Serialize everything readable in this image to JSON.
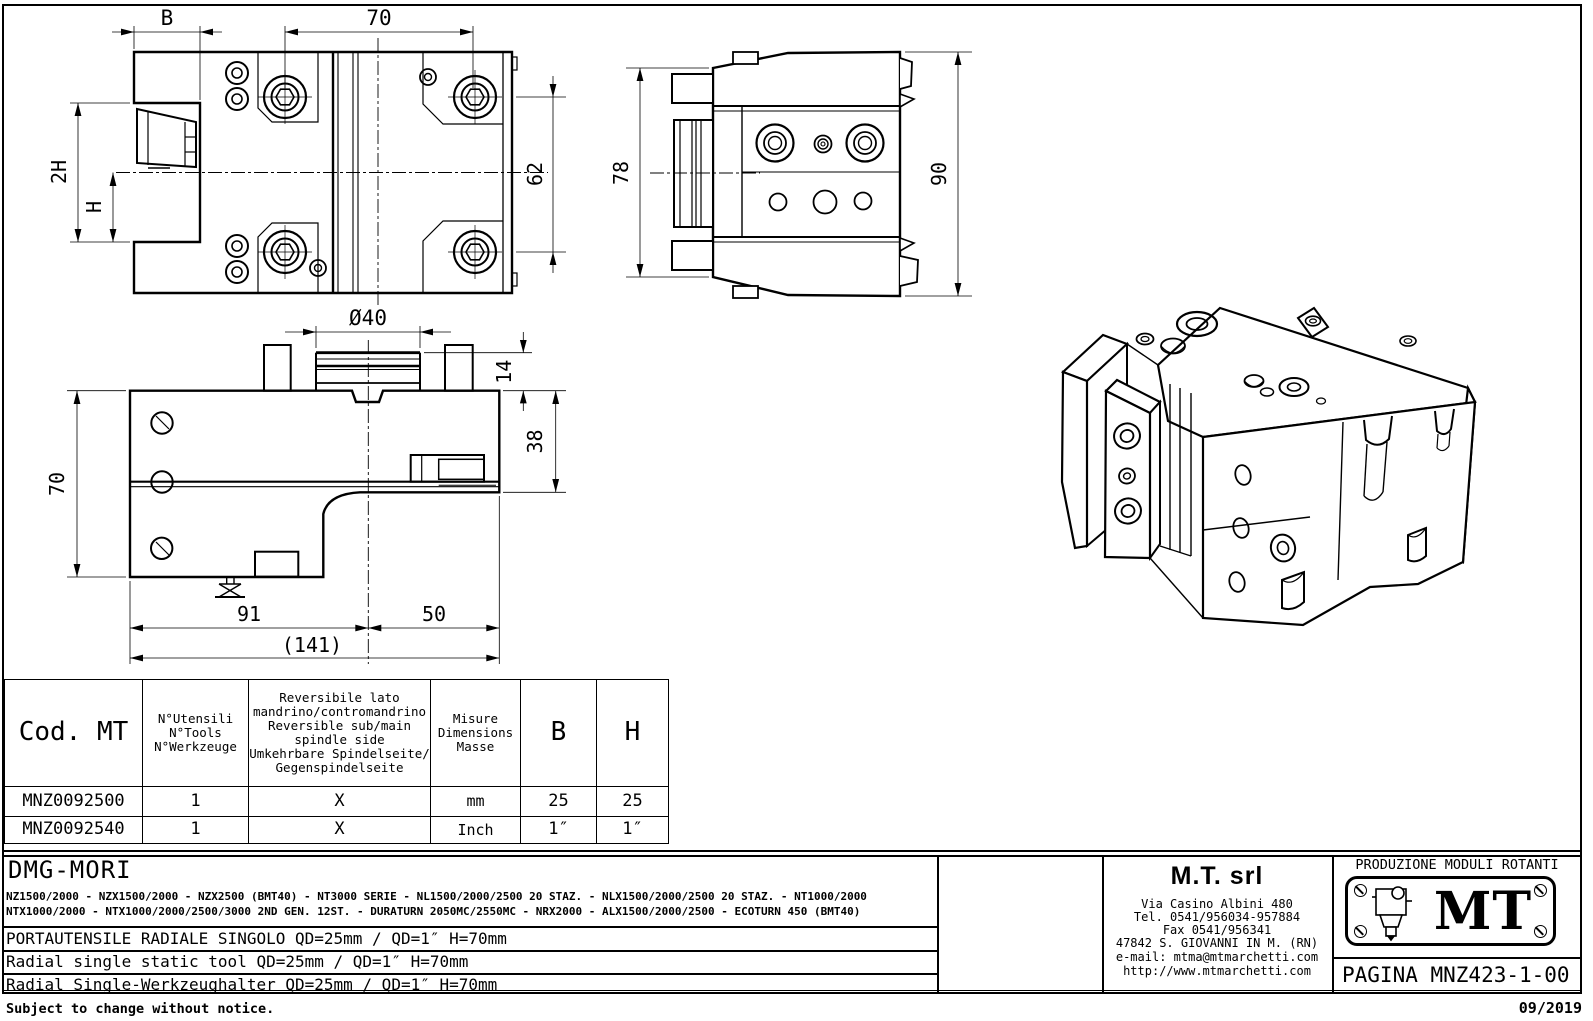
{
  "drawing": {
    "top_view": {
      "dim_b": "B",
      "dim_width": "70",
      "dim_2h": "2H",
      "dim_h": "H",
      "dim_62": "62"
    },
    "side_view": {
      "dim_78": "78",
      "dim_90": "90"
    },
    "front_view": {
      "dim_dia": "Ø40",
      "dim_14": "14",
      "dim_38": "38",
      "dim_70": "70",
      "dim_91": "91",
      "dim_50": "50",
      "dim_total": "(141)"
    }
  },
  "table": {
    "header": {
      "cod": "Cod. MT",
      "tools": [
        "N°Utensili",
        "N°Tools",
        "N°Werkzeuge"
      ],
      "reversible": [
        "Reversibile lato",
        "mandrino/contromandrino",
        "Reversible sub/main",
        "spindle side",
        "Umkehrbare Spindelseite/",
        "Gegenspindelseite"
      ],
      "measure": [
        "Misure",
        "Dimensions",
        "Masse"
      ],
      "b": "B",
      "h": "H"
    },
    "rows": [
      {
        "cod": "MNZ0092500",
        "tools": "1",
        "rev": "X",
        "unit": "mm",
        "b": "25",
        "h": "25"
      },
      {
        "cod": "MNZ0092540",
        "tools": "1",
        "rev": "X",
        "unit": "Inch",
        "b": "1″",
        "h": "1″"
      }
    ]
  },
  "title_block": {
    "brand": "DMG-MORI",
    "machines_line1": "NZ1500/2000 - NZX1500/2000 - NZX2500 (BMT40) - NT3000 SERIE - NL1500/2000/2500 20 STAZ. - NLX1500/2000/2500 20 STAZ. - NT1000/2000",
    "machines_line2": "NTX1000/2000 - NTX1000/2000/2500/3000 2ND GEN. 12ST. - DURATURN 2050MC/2550MC - NRX2000 - ALX1500/2000/2500 - ECOTURN 450 (BMT40)",
    "desc_it": "PORTAUTENSILE RADIALE SINGOLO QD=25mm / QD=1″ H=70mm",
    "desc_en": "Radial single static tool QD=25mm / QD=1″ H=70mm",
    "desc_de": "Radial Single-Werkzeughalter QD=25mm / QD=1″ H=70mm",
    "company": {
      "name": "M.T. srl",
      "address": "Via Casino Albini 480",
      "tel": "Tel. 0541/956034-957884",
      "fax": "Fax 0541/956341",
      "city": "47842 S. GIOVANNI IN M. (RN)",
      "email": "e-mail: mtma@mtmarchetti.com",
      "web": "http://www.mtmarchetti.com"
    },
    "production": "PRODUZIONE MODULI ROTANTI",
    "logo_text": "MT",
    "page": "PAGINA MNZ423-1-00",
    "note": "Subject to change without notice.",
    "date": "09/2019"
  }
}
